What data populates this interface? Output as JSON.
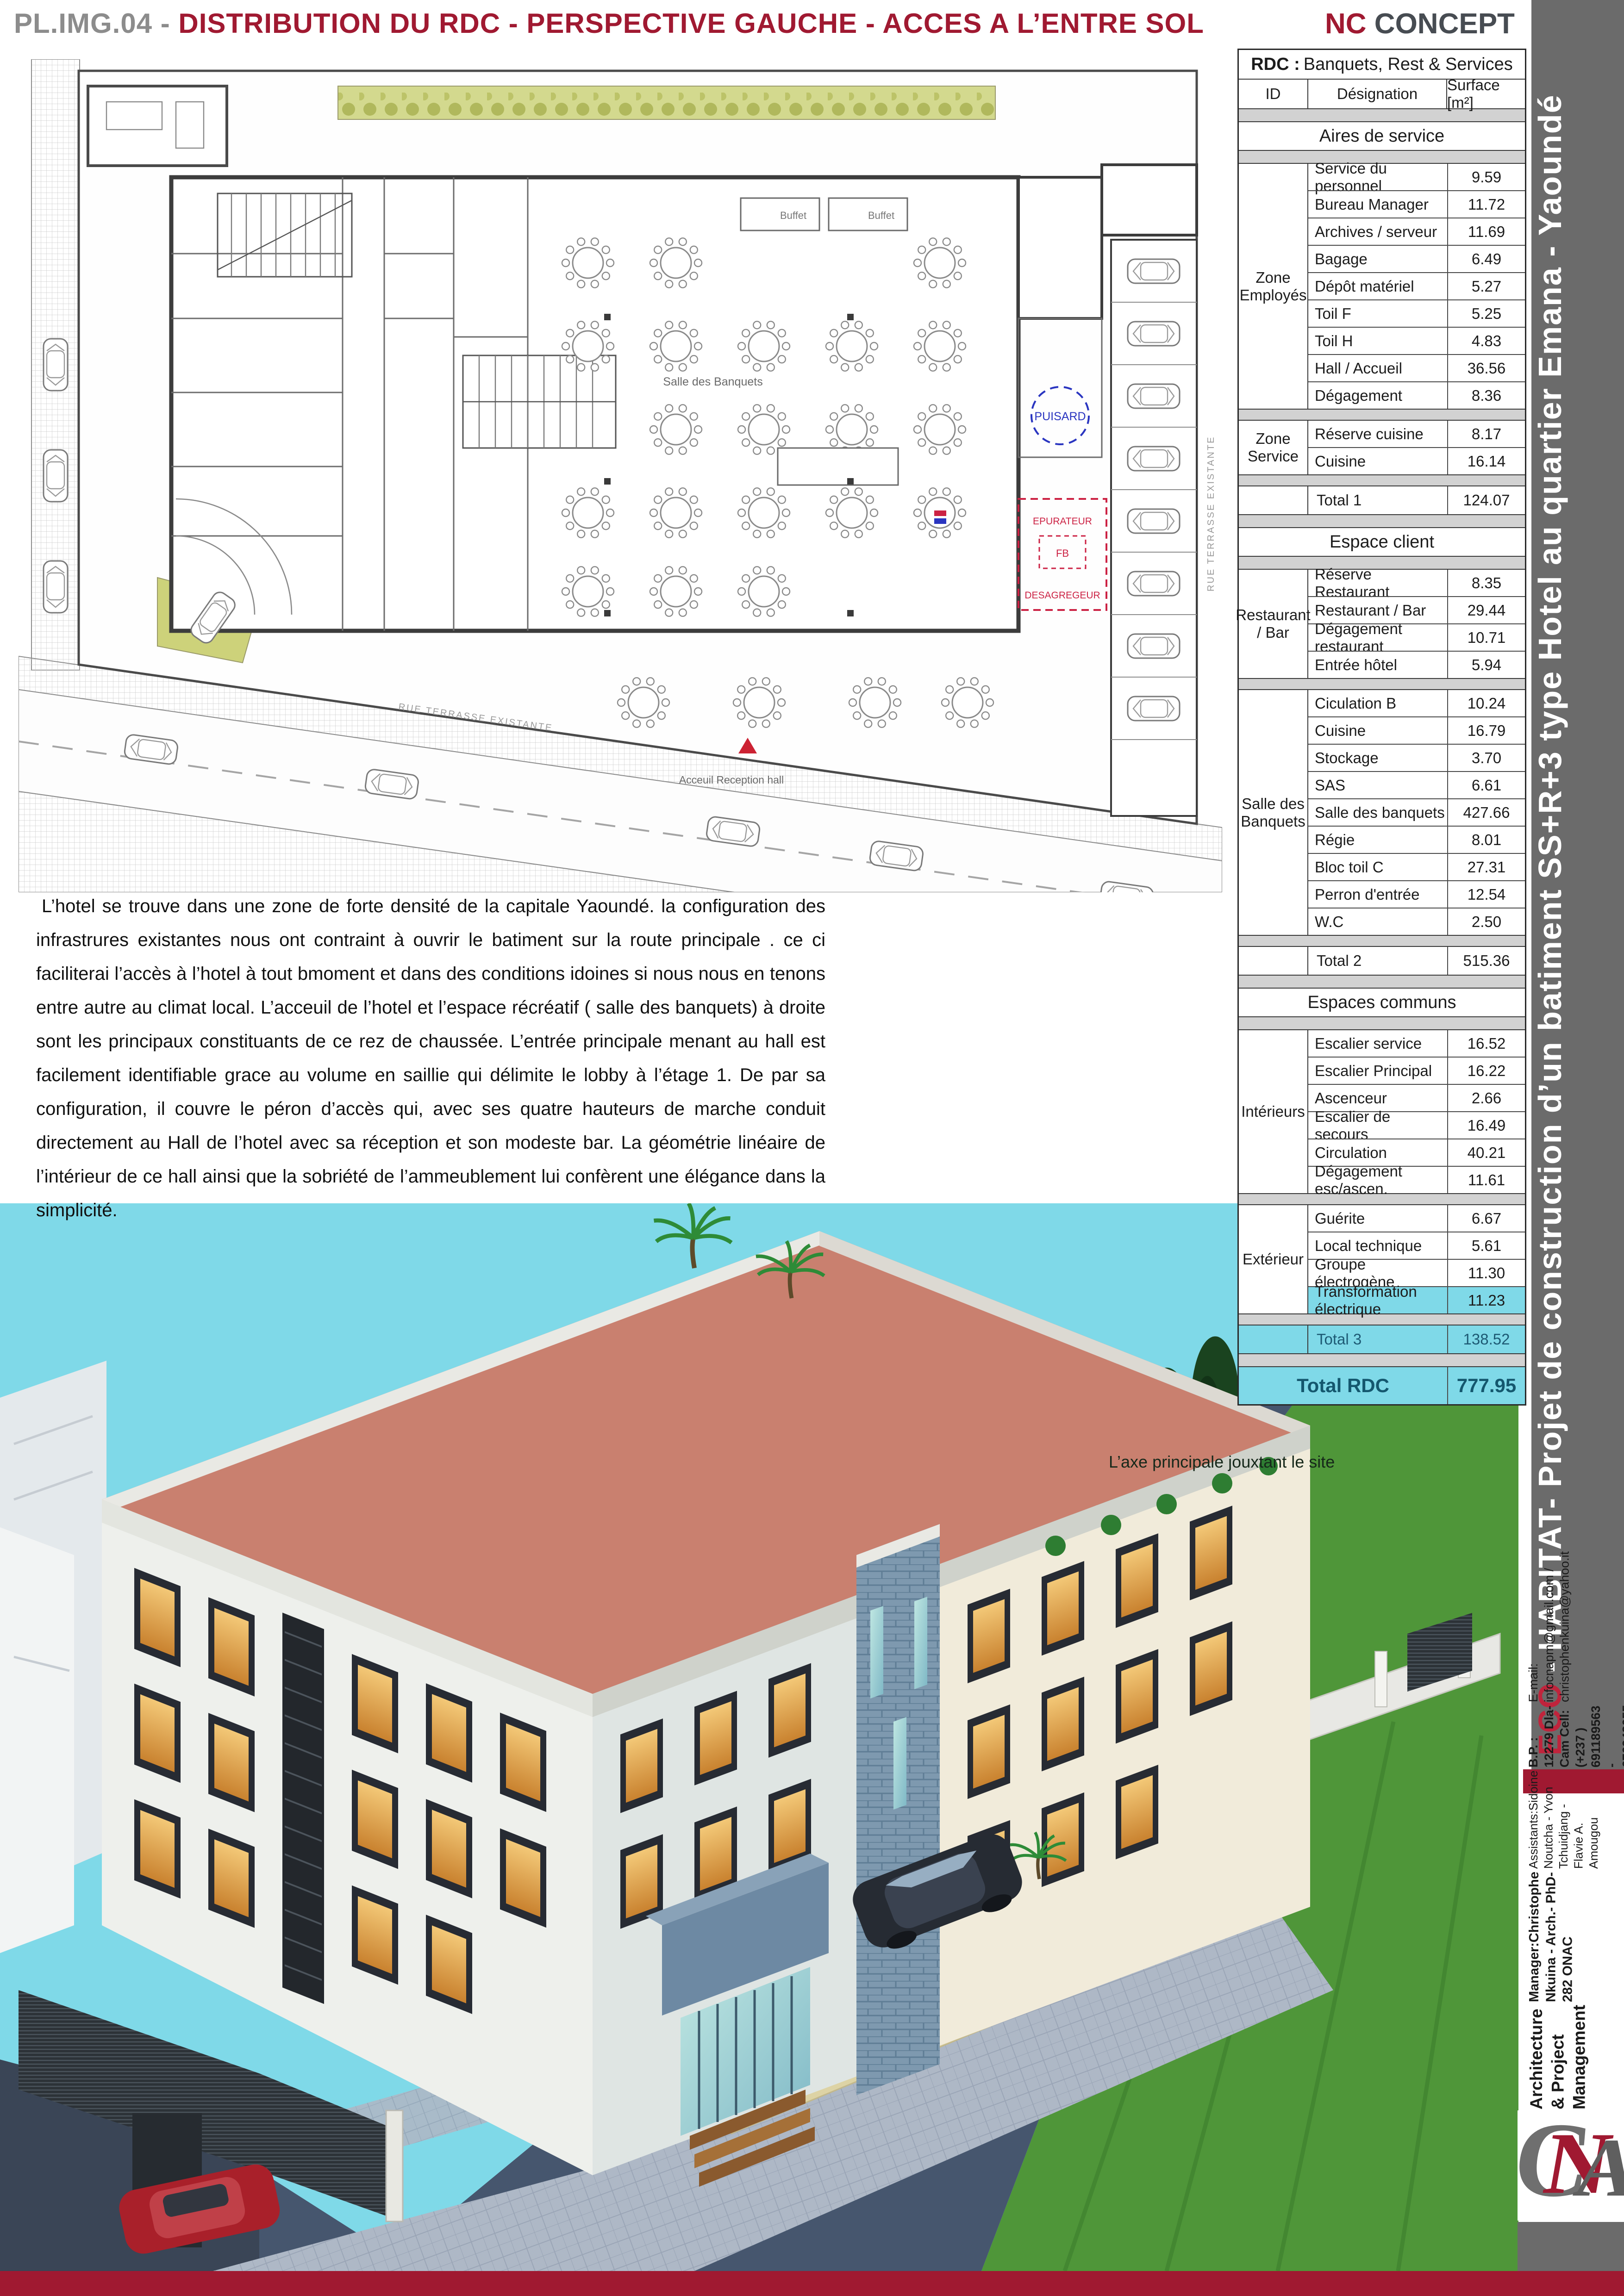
{
  "header": {
    "code": "PL.IMG.04 -",
    "title": " DISTRIBUTION DU RDC - PERSPECTIVE GAUCHE - ACCES A L’ENTRE SOL",
    "brand_red": "NC",
    "brand_rest": " CONCEPT"
  },
  "sidebar": {
    "title_red": "ECO",
    "title_rest": " - HABITAT- Projet de construction d’un batiment SS+R+3 type Hotel au quartier Emana - Yaoundé"
  },
  "contact": {
    "line1": "Architecture &  Project Management",
    "line2": "Manager:Christophe Nkuina - Arch.- PhD- 282 ONAC",
    "line3": "Assistants:Sidoine Noutcha - Yvon Tchuidjang - Flavie A. Amougou",
    "line4": "B.P. : 12279 Dla-Cam    Cell: (+237 ) 691189563 - 676942055",
    "line5": "E-mail: infocnapm@gmail.com  / christophenkuina@yahoo.it"
  },
  "logo": {
    "l1": "C",
    "l2": "N",
    "l3": "A"
  },
  "description": "L’hotel se trouve dans une zone de forte densité de la capitale Yaoundé. la configuration des infrastrures existantes nous ont contraint à ouvrir le batiment sur la route principale . ce ci faciliterai l’accès à l’hotel à tout bmoment et dans des conditions idoines si nous nous en tenons entre autre au climat local. L’acceuil de l’hotel et l’espace récréatif ( salle des banquets) à droite sont les principaux constituants de ce rez de chaussée. L’entrée principale menant au hall est facilement identifiable grace au volume en saillie qui délimite le lobby à l’étage 1. De par sa configuration, il couvre le péron d’accès qui, avec ses quatre hauteurs de marche conduit directement au Hall de l’hotel avec sa réception et son modeste bar. La géométrie linéaire de l’intérieur de ce hall ainsi que la sobriété de l’ammeublement lui confèrent une élégance  dans la simplicité.",
  "render_caption": "L’axe principale jouxtant le site",
  "plan": {
    "street_label": "RUE  TERRASSE  EXISTANTE",
    "banquet_label": "Salle des Banquets",
    "reception_label": "Acceuil Reception hall",
    "puisard": "PUISARD",
    "epurateur": "EPURATEUR",
    "fb": "FB",
    "desagregeur": "DESAGREGEUR",
    "buffet": "Buffet"
  },
  "colors": {
    "accent_red": "#a01931",
    "highlight_cyan": "#7fd9e8",
    "sidebar_gray": "#6b6b6b"
  },
  "table": {
    "title_bold": "RDC :",
    "title_rest": " Banquets, Rest & Services",
    "columns": [
      "ID",
      "Désignation",
      "Surface [m²]"
    ],
    "sections": [
      {
        "heading": "Aires de service",
        "groups": [
          {
            "zone": "Zone Employés",
            "rows": [
              [
                "Service du personnel",
                "9.59"
              ],
              [
                "Bureau Manager",
                "11.72"
              ],
              [
                "Archives / serveur",
                "11.69"
              ],
              [
                "Bagage",
                "6.49"
              ],
              [
                "Dépôt matériel",
                "5.27"
              ],
              [
                "Toil F",
                "5.25"
              ],
              [
                "Toil H",
                "4.83"
              ],
              [
                "Hall / Accueil",
                "36.56"
              ],
              [
                "Dégagement",
                "8.36"
              ]
            ]
          },
          {
            "zone": "Zone Service",
            "rows": [
              [
                "Réserve cuisine",
                "8.17"
              ],
              [
                "Cuisine",
                "16.14"
              ]
            ]
          }
        ],
        "total": [
          "Total  1",
          "124.07",
          false
        ]
      },
      {
        "heading": "Espace client",
        "groups": [
          {
            "zone": "Restaurant / Bar",
            "rows": [
              [
                "Réserve Restaurant",
                "8.35"
              ],
              [
                "Restaurant / Bar",
                "29.44"
              ],
              [
                "Dégagement  restaurant",
                "10.71"
              ],
              [
                "Entrée  hôtel",
                "5.94"
              ]
            ]
          },
          {
            "zone": "Salle des Banquets",
            "rows": [
              [
                "Ciculation B",
                "10.24"
              ],
              [
                "Cuisine",
                "16.79"
              ],
              [
                "Stockage",
                "3.70"
              ],
              [
                "SAS",
                "6.61"
              ],
              [
                "Salle des banquets",
                "427.66"
              ],
              [
                "Régie",
                "8.01"
              ],
              [
                "Bloc toil C",
                "27.31"
              ],
              [
                "Perron d'entrée",
                "12.54"
              ],
              [
                "W.C",
                "2.50"
              ]
            ]
          }
        ],
        "total": [
          "Total 2",
          "515.36",
          false
        ]
      },
      {
        "heading": "Espaces communs",
        "groups": [
          {
            "zone": "Intérieurs",
            "rows": [
              [
                "Escalier service",
                "16.52"
              ],
              [
                "Escalier Principal",
                "16.22"
              ],
              [
                "Ascenceur",
                "2.66"
              ],
              [
                "Escalier de secours",
                "16.49"
              ],
              [
                "Circulation",
                "40.21"
              ],
              [
                "Dégagement esc/ascen.",
                "11.61"
              ]
            ]
          },
          {
            "zone": "Extérieur",
            "rows": [
              [
                "Guérite",
                "6.67"
              ],
              [
                "Local technique",
                "5.61"
              ],
              [
                "Groupe électrogène",
                "11.30"
              ],
              [
                "Transformation électrique",
                "11.23",
                "hl"
              ]
            ]
          }
        ],
        "total": [
          "Total 3",
          "138.52",
          true
        ]
      }
    ],
    "grand_total": [
      "Total RDC",
      "777.95"
    ]
  }
}
